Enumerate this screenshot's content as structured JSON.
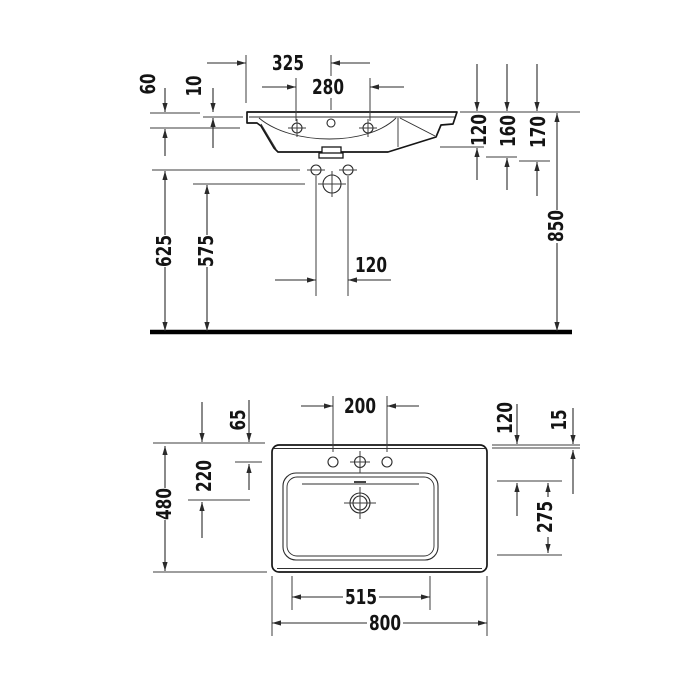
{
  "drawing": {
    "front_view": {
      "dims": {
        "left_edge_to_center": "325",
        "hole_spacing": "280",
        "rim_to_hole_drop": "60",
        "rim_thickness": "10",
        "rim_to_basin_bottom": "120",
        "rim_to_drain": "160",
        "rim_to_drain_bottom": "170",
        "rim_height_from_floor": "850",
        "mount_holes_to_floor": "625",
        "siphon_to_floor": "575",
        "mount_hole_spacing": "120"
      }
    },
    "plan_view": {
      "dims": {
        "faucet_hole_spacing": "200",
        "back_to_faucet_holes": "65",
        "back_to_drain": "220",
        "overall_depth": "480",
        "back_to_basin_front": "120",
        "back_rim_width": "15",
        "basin_depth": "275",
        "basin_width": "515",
        "overall_width": "800"
      }
    },
    "line_color": "#161616",
    "background_color": "#ffffff"
  }
}
